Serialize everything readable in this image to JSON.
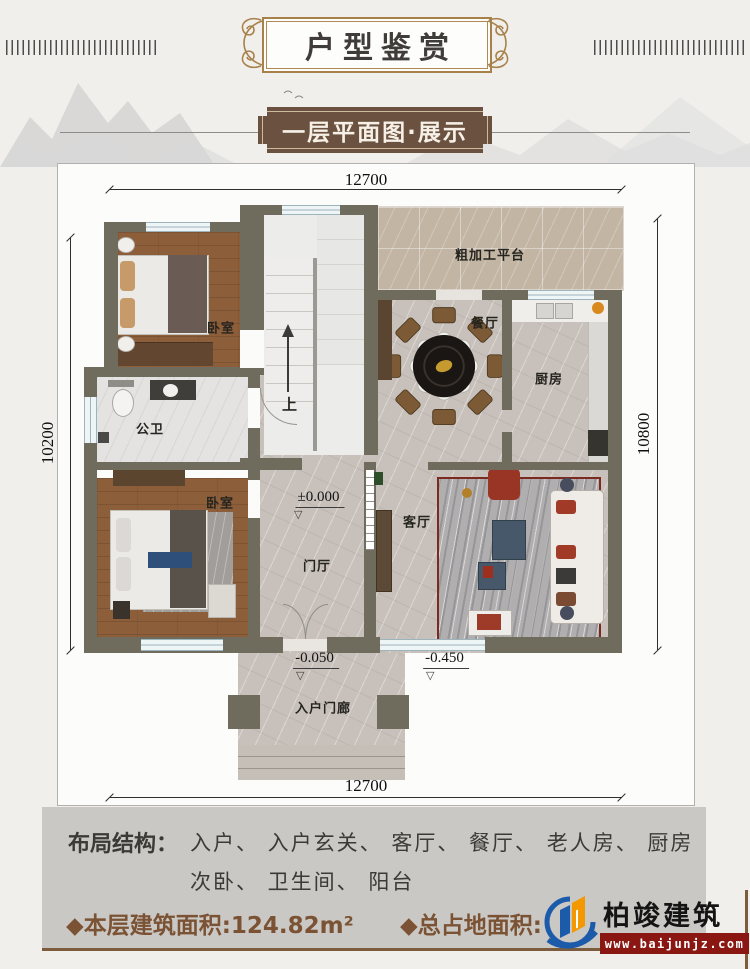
{
  "header": {
    "title": "户型鉴赏",
    "subtitle": "一层平面图·展示"
  },
  "plan": {
    "dim_top": "12700",
    "dim_bottom": "12700",
    "dim_left": "10200",
    "dim_right": "10800",
    "rooms": {
      "bedroom_top": "卧室",
      "bedroom_bottom": "卧室",
      "bathroom": "公卫",
      "dining": "餐厅",
      "kitchen": "厨房",
      "living": "客厅",
      "foyer": "门厅",
      "platform": "粗加工平台",
      "porch": "入户门廊",
      "stair_up": "上"
    },
    "levels": {
      "ground": "±0.000",
      "porch": "-0.050",
      "yard": "-0.450"
    },
    "icons": {
      "level_triangle": "▽"
    }
  },
  "footer": {
    "layout_label": "布局结构：",
    "layout_line1": "入户、 入户玄关、 客厅、 餐厅、 老人房、 厨房",
    "layout_line2": "次卧、 卫生间、 阳台",
    "floor_area": "◆本层建筑面积:124.82m²",
    "total_area_label": "◆总占地面积:",
    "brand": {
      "name": "柏竣建筑",
      "url": "www.baijunjz.com"
    }
  },
  "colors": {
    "wall": "#6f6c5e",
    "accent_brown": "#7b5233",
    "plaque_brown": "#6b5140",
    "logo_blue": "#1c5ba9",
    "logo_orange": "#f39800",
    "logo_red_band": "#8a1712"
  }
}
